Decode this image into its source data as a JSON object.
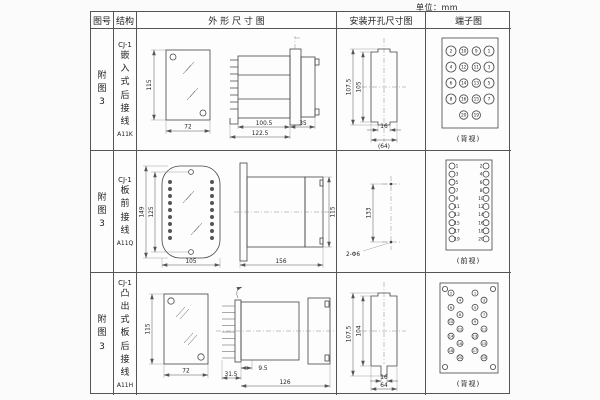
{
  "page": {
    "unit_label": "单位：mm"
  },
  "headers": {
    "fig_no": "图号",
    "structure": "结构",
    "outline": "外 形 尺 寸 图",
    "install": "安装开孔尺寸图",
    "terminal": "端子图"
  },
  "rows": [
    {
      "fig_no": "附图3",
      "structure_top": "CJ-1",
      "structure_name": "嵌入式后接线",
      "model": "A11K",
      "outline": {
        "front_h": "115",
        "front_w": "72",
        "d1": "100.5",
        "d2": "122.5",
        "d3": "35"
      },
      "install": {
        "v1": "107.5",
        "v2": "105",
        "h1": "16",
        "h2": "(64)"
      },
      "terminal": {
        "type": "back-grid",
        "caption": "(背视)",
        "grid": [
          [
            "2",
            "10",
            "9",
            "1"
          ],
          [
            "4",
            "12",
            "11",
            "3"
          ],
          [
            "6",
            "14",
            "13",
            "5"
          ],
          [
            "8",
            "16",
            "15",
            "7"
          ]
        ],
        "bottom": [
          "20",
          "19"
        ]
      }
    },
    {
      "fig_no": "附图3",
      "structure_top": "CJ-1",
      "structure_name": "板前接线",
      "model": "A11Q",
      "outline": {
        "front_h_outer": "149",
        "front_h_inner": "125",
        "front_w": "105",
        "side_len": "156",
        "side_h": "115"
      },
      "install": {
        "v1": "133",
        "hole_label": "2-Φ6"
      },
      "terminal": {
        "type": "front-cols",
        "caption": "(前视)",
        "left": [
          "1",
          "3",
          "5",
          "7",
          "9",
          "11",
          "13",
          "15",
          "17",
          "19"
        ],
        "right": [
          "2",
          "4",
          "6",
          "8",
          "10",
          "12",
          "14",
          "16",
          "18",
          "20"
        ]
      }
    },
    {
      "fig_no": "附图3",
      "structure_top": "CJ-1",
      "structure_name": "凸出式板后接线",
      "model": "A11H",
      "outline": {
        "front_h": "115",
        "front_w": "72",
        "d1": "31.5",
        "d2": "9.5",
        "d3": "126"
      },
      "install": {
        "v1": "107.5",
        "v2": "104",
        "h1": "16",
        "h2": "64"
      },
      "terminal": {
        "type": "zigzag",
        "caption": "(背视)",
        "left": [
          "2",
          "4",
          "6",
          "8",
          "10",
          "12",
          "14",
          "16",
          "18",
          "20"
        ],
        "right": [
          "1",
          "3",
          "5",
          "7",
          "9",
          "11",
          "13",
          "15",
          "17",
          "19"
        ]
      }
    }
  ]
}
